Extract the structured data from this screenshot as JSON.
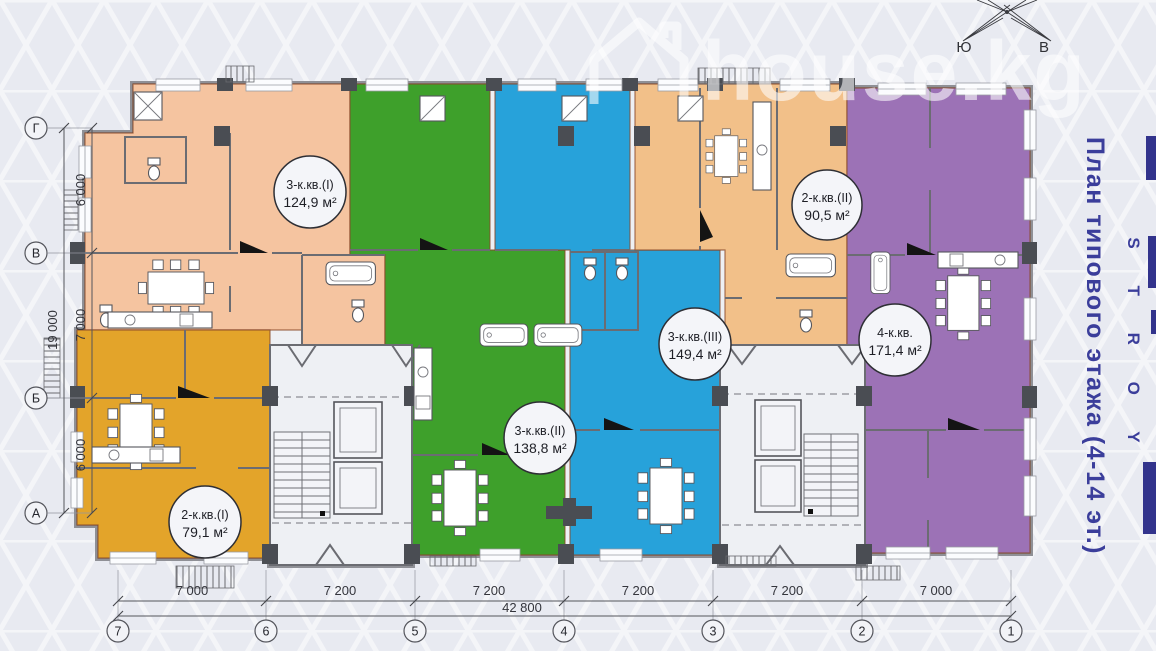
{
  "watermark": {
    "text": "house.kg"
  },
  "compass": {
    "south": "Ю",
    "east": "В"
  },
  "brochure": {
    "title_vertical": "План типового этажа (4-14 эт.)",
    "brand_letters": "S T R O Y",
    "color": "#3b3e9b",
    "fragment_color": "#32338c"
  },
  "apartments": [
    {
      "name": "3-к.кв.(I)",
      "area": "124,9 м²",
      "color": "#f5c4a0"
    },
    {
      "name": "3-к.кв.(II)",
      "area": "138,8 м²",
      "color": "#3ea02b"
    },
    {
      "name": "3-к.кв.(III)",
      "area": "149,4 м²",
      "color": "#27a2da"
    },
    {
      "name": "2-к.кв.(II)",
      "area": "90,5 м²",
      "color": "#f2c089"
    },
    {
      "name": "4-к.кв.",
      "area": "171,4 м²",
      "color": "#9c72b6"
    },
    {
      "name": "2-к.кв.(I)",
      "area": "79,1 м²",
      "color": "#e3a42a"
    }
  ],
  "dimensions": {
    "bottom_segments": [
      "7 000",
      "7 200",
      "7 200",
      "7 200",
      "7 200",
      "7 000"
    ],
    "bottom_total": "42 800",
    "left_segments": [
      "6 000",
      "7 000",
      "6 000"
    ],
    "left_total": "19 000"
  },
  "grid": {
    "columns": [
      "7",
      "6",
      "5",
      "4",
      "3",
      "2",
      "1"
    ],
    "rows": [
      "Г",
      "В",
      "Б",
      "А"
    ]
  }
}
